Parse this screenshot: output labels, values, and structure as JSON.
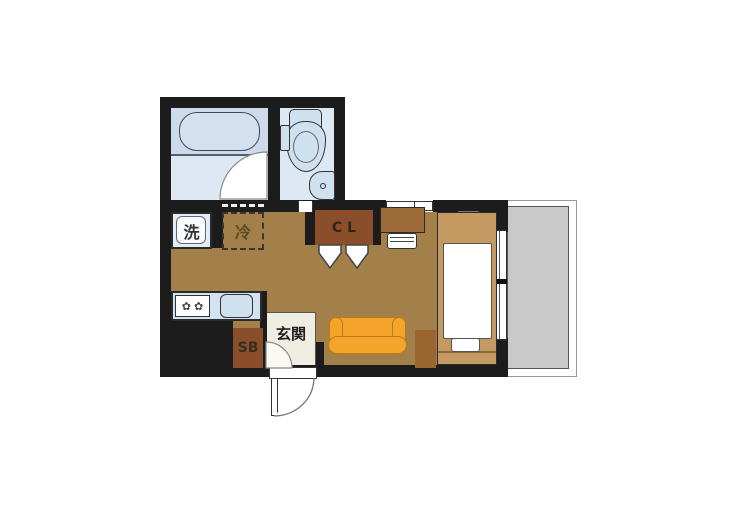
{
  "floorplan": {
    "labels": {
      "washing_machine": "洗",
      "refrigerator": "冷",
      "closet": "CL",
      "shoe_box": "SB",
      "entrance": "玄関"
    },
    "icons": {
      "stove_burner": "✿"
    },
    "colors": {
      "wall": "#1c1c1c",
      "room_floor": "#a3804a",
      "entrance_floor": "#efece1",
      "wet_area_floor": "#dde8f3",
      "bath_zone": "#ccdae9",
      "fixture_fill": "#cfe0ee",
      "kitchen_counter": "#d3e2f0",
      "closet_brown": "#8a4e2a",
      "furniture_wood": "#9c6a38",
      "bed_frame": "#c49a62",
      "sofa_orange": "#f4a42a",
      "balcony_gray": "#c9c9c9"
    }
  }
}
